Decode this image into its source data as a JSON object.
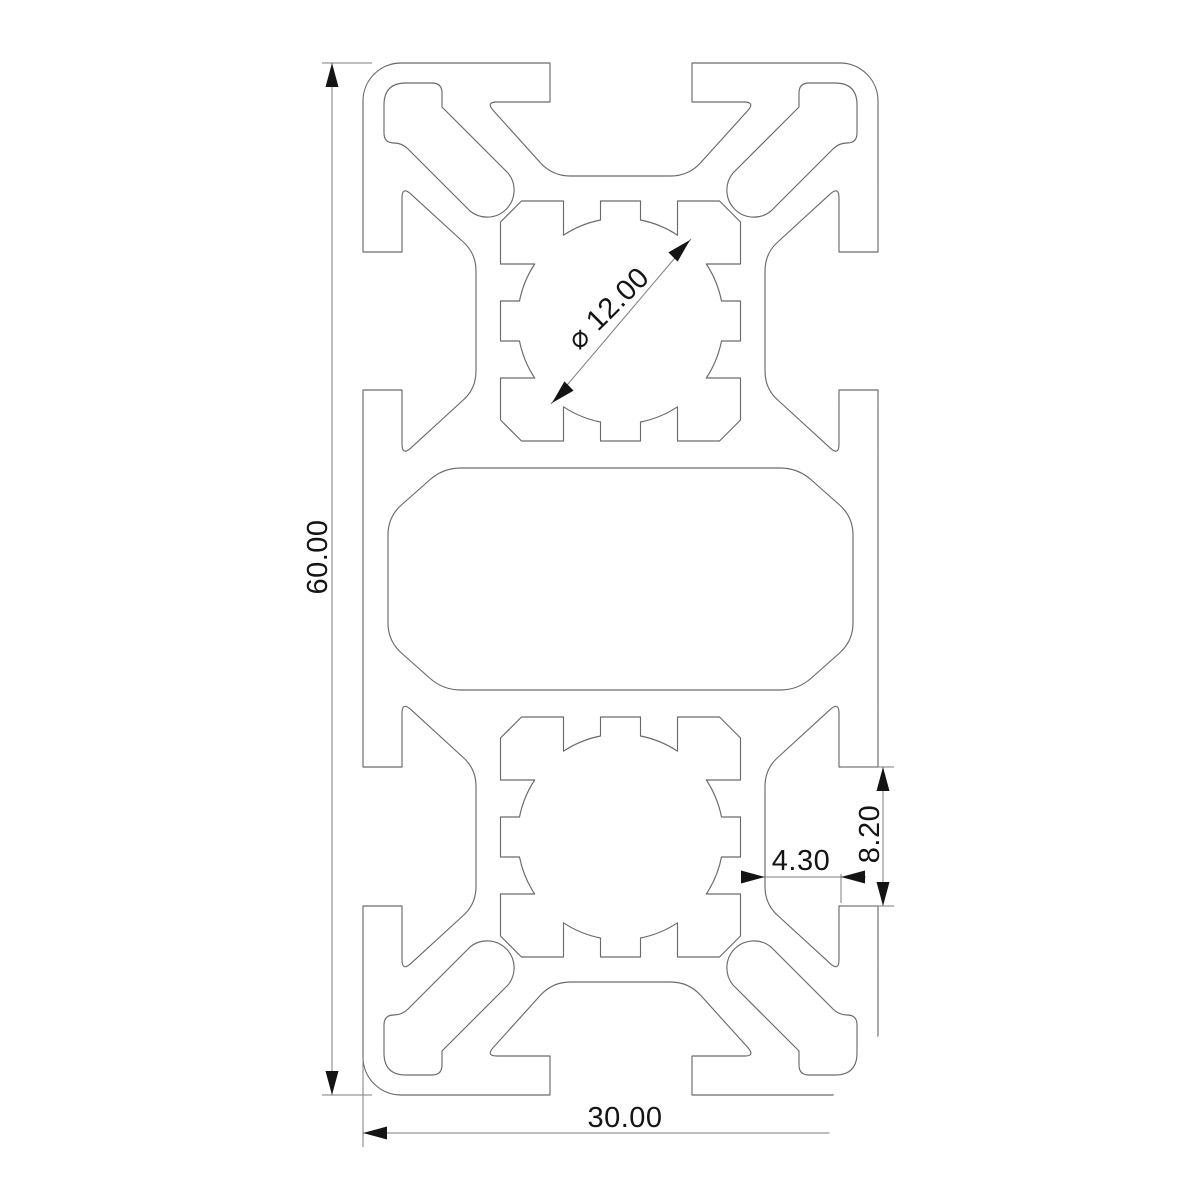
{
  "drawing": {
    "type": "technical-cad-cross-section",
    "labels": {
      "height": "60.00",
      "width": "30.00",
      "bore_diameter": "⌀ 12.00",
      "slot_neck_width": "4.30",
      "slot_opening_height": "8.20"
    },
    "colors": {
      "background": "#ffffff",
      "profile-line": "#6a6a6a",
      "dim-line": "#7d7d7d",
      "dim-text": "#141414"
    }
  }
}
